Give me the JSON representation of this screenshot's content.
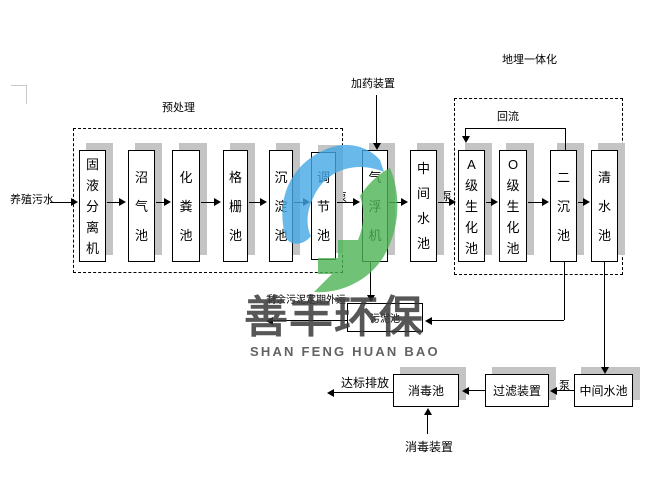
{
  "colors": {
    "logo_blue": "#44a9e6",
    "logo_green": "#4db456",
    "box_shadow": "#c4c4c4",
    "line": "#000000"
  },
  "watermark": {
    "brand_cn": "善丰环保",
    "brand_en": "SHAN FENG HUAN BAO"
  },
  "flow": {
    "source": "养殖污水",
    "pretreatment_label": "预处理",
    "buried_label": "地埋一体化",
    "dosing_label": "加药装置",
    "reflux_label": "回流",
    "pump_label": "泵",
    "sludge_note": "剩余污泥定期外运",
    "discharge_label": "达标排放",
    "disinfection_device_label": "消毒装置",
    "tanks": [
      "固液分离机",
      "沼气池",
      "化粪池",
      "格栅池",
      "沉淀池",
      "调节池",
      "气浮机",
      "中间水池",
      "A级生化池",
      "O级生化池",
      "二沉池",
      "清水池"
    ],
    "sludge_tank": "污泥池",
    "bottom_tanks": [
      "消毒池",
      "过滤装置",
      "中间水池"
    ]
  }
}
